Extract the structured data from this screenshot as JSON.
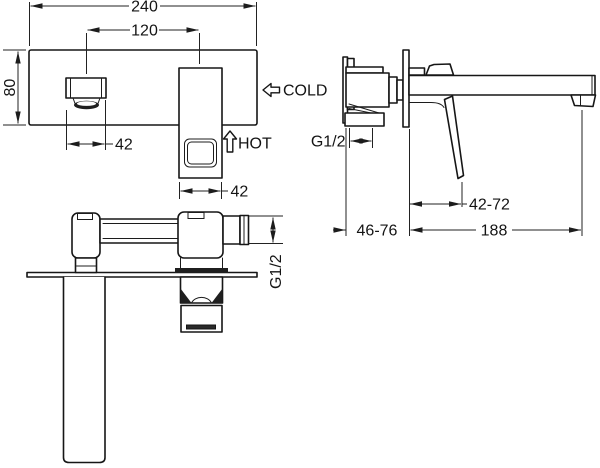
{
  "drawing": {
    "front_view": {
      "overall_width": "240",
      "spout_to_handle_spacing": "120",
      "plate_height": "80",
      "spout_width": "42",
      "handle_width": "42",
      "cold_label": "COLD",
      "hot_label": "HOT"
    },
    "side_view": {
      "inlet_thread": "G1/2",
      "handle_projection": "42-72",
      "concealed_depth": "46-76",
      "spout_reach": "188"
    },
    "top_view": {
      "outlet_thread": "G1/2"
    },
    "colors": {
      "line": "#161616",
      "background": "#ffffff"
    }
  }
}
